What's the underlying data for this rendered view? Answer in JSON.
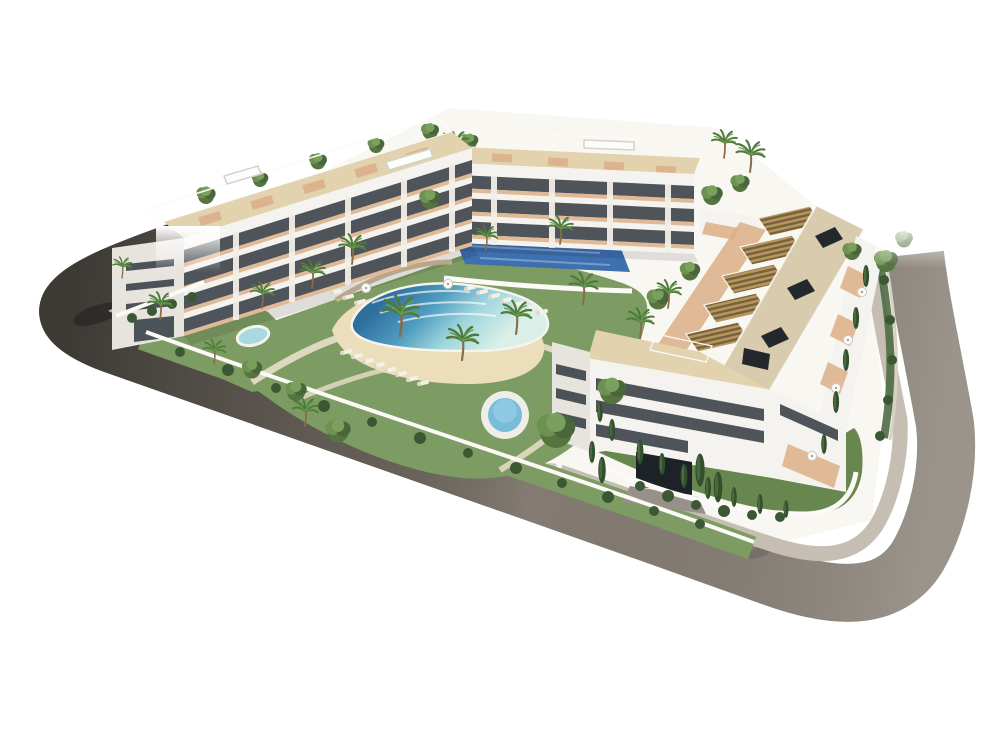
{
  "scene": {
    "title": "Aerial 3D architectural rendering of a white residential apartment complex with rooftop pergolas, a central lagoon pool with sand beach, round jacuzzi, blue sports deck, palm trees, gardens and a curved perimeter road",
    "background": "#ffffff"
  },
  "palette": {
    "road": "#847c72",
    "road_dark": "#45413d",
    "sidewalk": "#c6beb2",
    "curb": "#e8e4dd",
    "ground": "#f9f7f2",
    "lawn": "#7d9c63",
    "lawn_dark": "#68874f",
    "hedge": "#3c5733",
    "sand": "#ecddbb",
    "pool_deep": "#2e6f9e",
    "pool_light": "#d9efe8",
    "water_round": "#79bcd9",
    "sport_blue": "#3e6fae",
    "building": "#f5f3ef",
    "building_shade": "#e7e4de",
    "window": "#3f464c",
    "pergola": "#b5965f",
    "pergola_slat": "#77603a",
    "roof_deck": "#e2d2ae",
    "terrace": "#dcae87",
    "roof_beige": "#d8cbae",
    "hatch": "#23282c",
    "wall": "#fbfaf7",
    "palm": "#4e7a3c",
    "palm_light": "#6a9a4e",
    "cypress": "#33502e",
    "trunk": "#8a6b4a",
    "lounger": "#f3f0e8"
  },
  "features": [
    "perimeter road",
    "sidewalk and curb",
    "left apartment wing with rooftop pergolas",
    "back apartment wing with roof terraces",
    "right apartment wing with slatted pergola roof terraces",
    "lagoon pool with sand beach entry",
    "round jacuzzi pool",
    "blue sports deck",
    "private oval garden pool",
    "sun loungers and parasols",
    "palm trees, leafy trees, cypresses and hedges",
    "street-side terraces with white umbrellas",
    "garage entrance ramp"
  ]
}
